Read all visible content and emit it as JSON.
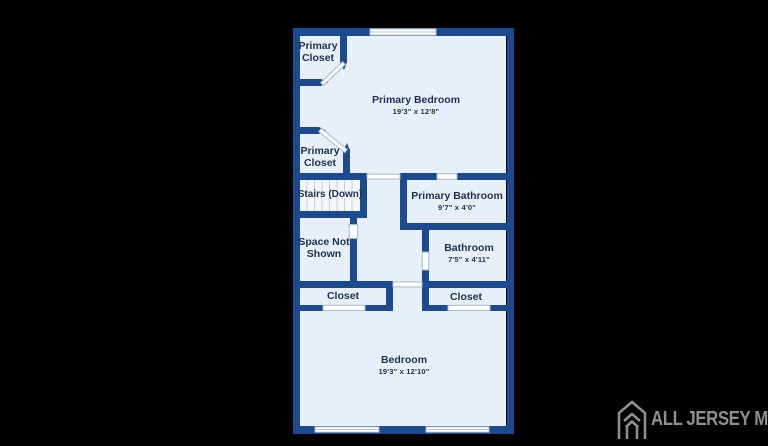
{
  "background_color": "#000000",
  "plan": {
    "wall_color": "#1b4a8f",
    "floor_color": "#e7eff8",
    "stairs_floor_color": "#f4f7fb",
    "label_color": "#1d3156",
    "door_outline_color": "#a9b8ca",
    "rooms": [
      {
        "id": "primary-closet-top",
        "name": "Primary Closet"
      },
      {
        "id": "primary-bedroom",
        "name": "Primary Bedroom",
        "dims": "19'3\" x 12'8\""
      },
      {
        "id": "primary-closet-mid",
        "name": "Primary Closet"
      },
      {
        "id": "stairs",
        "name": "Stairs (Down)"
      },
      {
        "id": "primary-bathroom",
        "name": "Primary Bathroom",
        "dims": "9'7\" x 4'0\""
      },
      {
        "id": "space-not-shown",
        "name": "Space Not Shown"
      },
      {
        "id": "bathroom",
        "name": "Bathroom",
        "dims": "7'5\" x 4'11\""
      },
      {
        "id": "closet-left",
        "name": "Closet"
      },
      {
        "id": "closet-right",
        "name": "Closet"
      },
      {
        "id": "bedroom",
        "name": "Bedroom",
        "dims": "19'3\" x 12'10\""
      }
    ]
  },
  "watermark": {
    "text": "ALL JERSEY MLS",
    "color": "#8f8f8f",
    "icon": "house-logo-icon"
  }
}
